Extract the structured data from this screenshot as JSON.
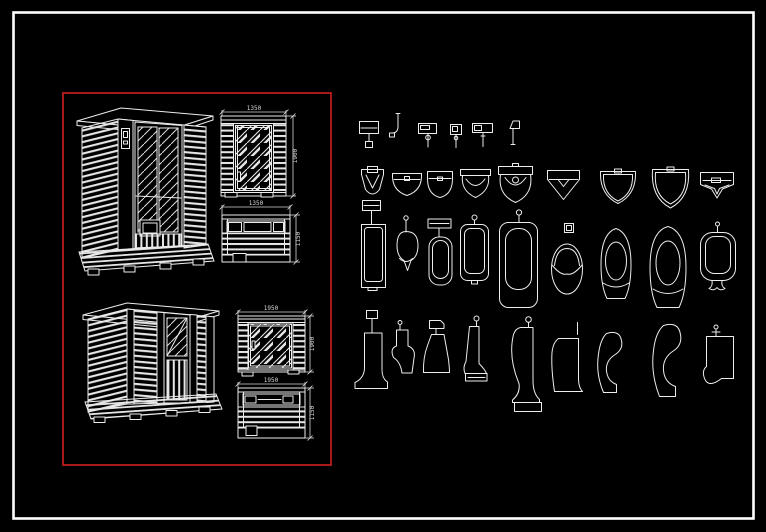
{
  "scene": {
    "type": "cad-drawing-sheet",
    "background": "#000000",
    "line_color": "#ededed",
    "frame_color": "#ffffff",
    "highlight_box_color": "#c61f1f"
  },
  "sauna_panel": {
    "label": "sauna-cabin-drawings",
    "dims": {
      "door_elevation_width": "1350",
      "door_elevation_height": "1900",
      "side_elevation_width": "1350",
      "side_elevation_height": "1150",
      "window_elevation_width": "1950",
      "window_elevation_height": "1900",
      "rear_elevation_width": "1950",
      "rear_elevation_height": "1150"
    }
  },
  "fixture_panel": {
    "label": "urinal-cad-blocks",
    "rows": [
      {
        "name": "flush-valve-symbols",
        "items": [
          "valve-wall-box",
          "valve-pipe-elbow",
          "valve-box-sensor",
          "valve-small-box",
          "valve-wide-box",
          "valve-flag"
        ]
      },
      {
        "name": "urinal-plan-views",
        "items": [
          "plan-v-spreader",
          "plan-round-v",
          "plan-u-flat",
          "plan-bar-bowl",
          "plan-tank-bowl",
          "plan-pointed",
          "plan-double-v",
          "plan-double-v-large",
          "plan-trapezoid"
        ]
      },
      {
        "name": "urinal-front-views",
        "items": [
          "front-stall-tank",
          "front-oval-valve",
          "front-shelf-bowl",
          "front-rounded-valve",
          "front-tall-pipe",
          "front-egg-chevron",
          "front-arch-small",
          "front-arch-large",
          "front-square-spout"
        ]
      },
      {
        "name": "urinal-side-views",
        "items": [
          "side-stall-pedestal",
          "side-curve-lip",
          "side-tank-angular",
          "side-slim-base",
          "side-tall-pedestal",
          "side-plain",
          "side-s-curve",
          "side-s-curve-large",
          "side-wall-hung-valve"
        ]
      }
    ]
  }
}
